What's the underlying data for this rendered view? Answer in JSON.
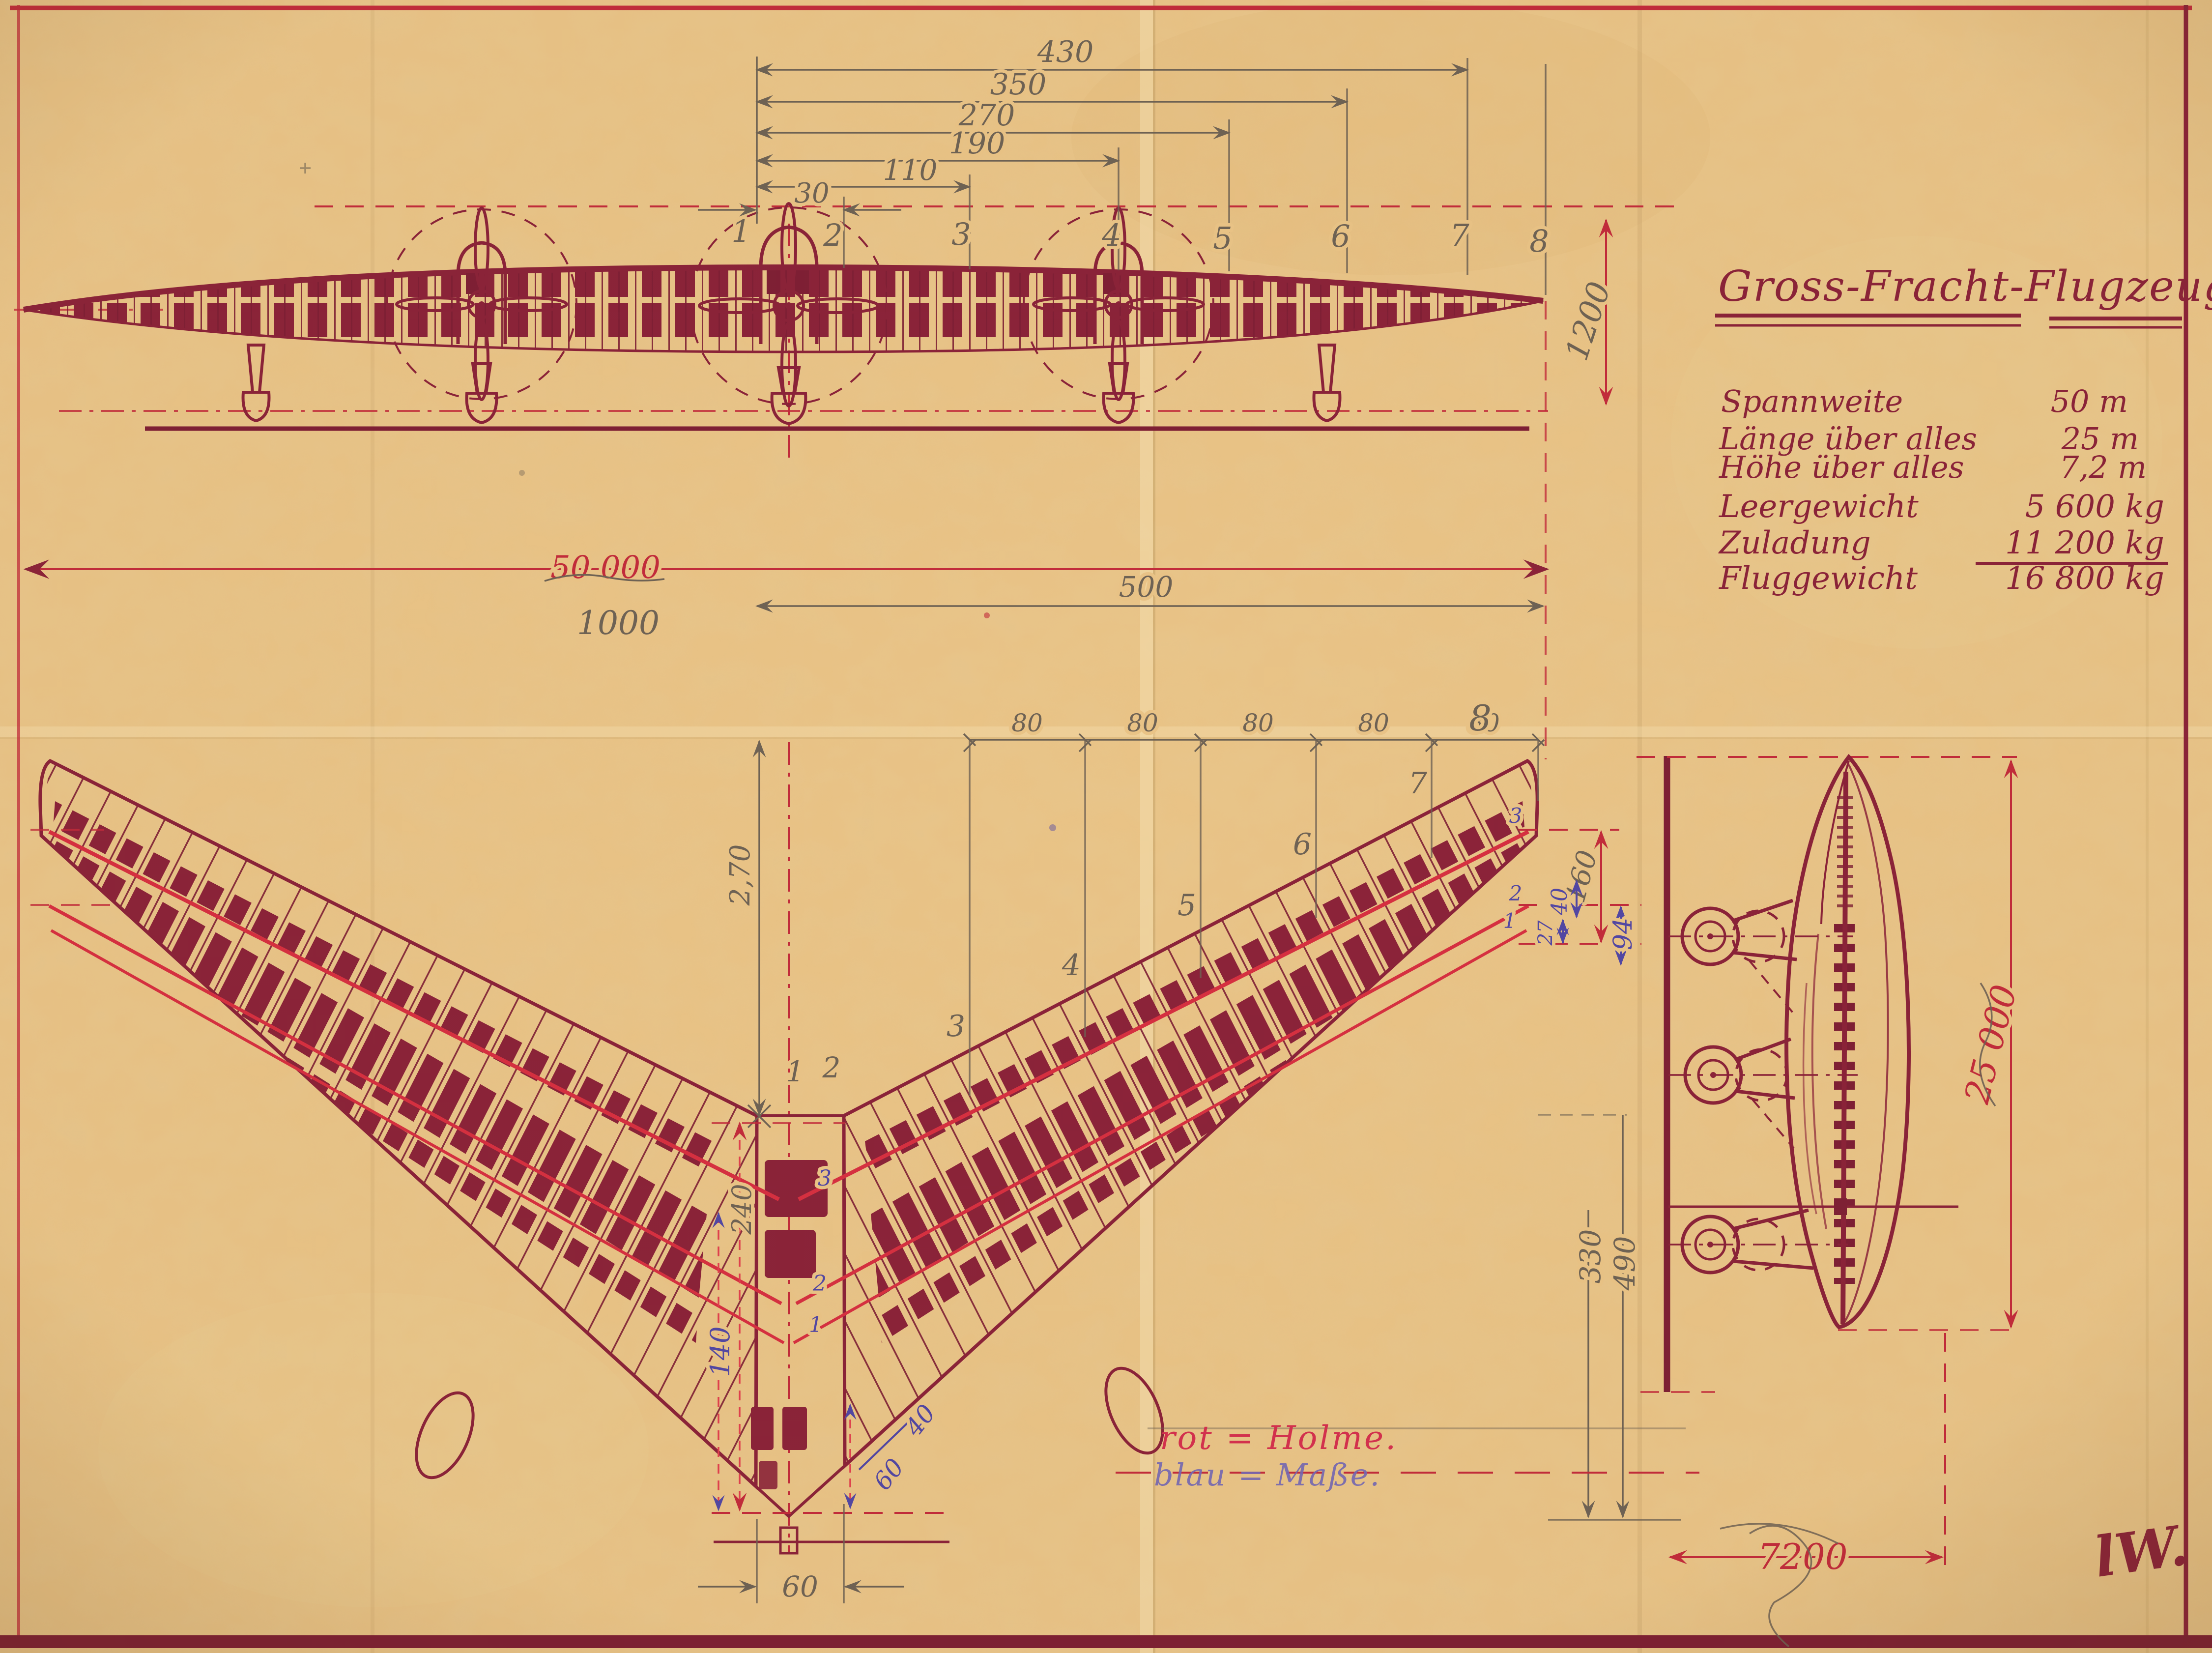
{
  "colors": {
    "paper": "#e9c386",
    "ink": "#8b2339",
    "ink_dark": "#7e1f34",
    "red": "#c22c3b",
    "blue": "#5247a3",
    "pencil": "#6e6254",
    "red_note": "#d4314e",
    "blue_note": "#7468b4"
  },
  "title_block": {
    "title": "Gross-Fracht-Flugzeug.",
    "specs": [
      {
        "label": "Spannweite",
        "value": "50 m"
      },
      {
        "label": "Länge über alles",
        "value": "25 m"
      },
      {
        "label": "Höhe über alles",
        "value": "7,2 m"
      }
    ],
    "weights": [
      {
        "label": "Leergewicht",
        "value": "5 600 kg"
      },
      {
        "label": "Zuladung",
        "value": "11 200 kg"
      },
      {
        "label": "Fluggewicht",
        "value": "16 800 kg"
      }
    ]
  },
  "front_view": {
    "station_dims": [
      "430",
      "350",
      "270",
      "190",
      "110",
      "30"
    ],
    "stations": [
      "1",
      "2",
      "3",
      "4",
      "5",
      "6",
      "7",
      "8"
    ],
    "tip_chord_dim": "1200",
    "span_dim_struck": "50 000",
    "span_dim_pencil": "1000",
    "half_span_dim": "500"
  },
  "plan_view": {
    "rib_spacing_dims": [
      "80",
      "80",
      "80",
      "80",
      "80"
    ],
    "stations": [
      "1",
      "2",
      "3",
      "4",
      "5",
      "6",
      "7",
      "8"
    ],
    "spar_numbers_root": [
      "3",
      "2",
      "1"
    ],
    "spar_numbers_tip": [
      "3",
      "2",
      "1"
    ],
    "root_chord_dim": "2,70",
    "root_dims": [
      "240",
      "140",
      "40",
      "60",
      "60"
    ],
    "tip_dims": [
      "160",
      "94",
      "40",
      "27"
    ],
    "side_dims": [
      "490",
      "330"
    ]
  },
  "side_view": {
    "length_dim": "25 000",
    "height_dim": "7200"
  },
  "legend": {
    "red_note": "rot = Holme.",
    "blue_note": "blau = Maße."
  },
  "signature": "lW."
}
